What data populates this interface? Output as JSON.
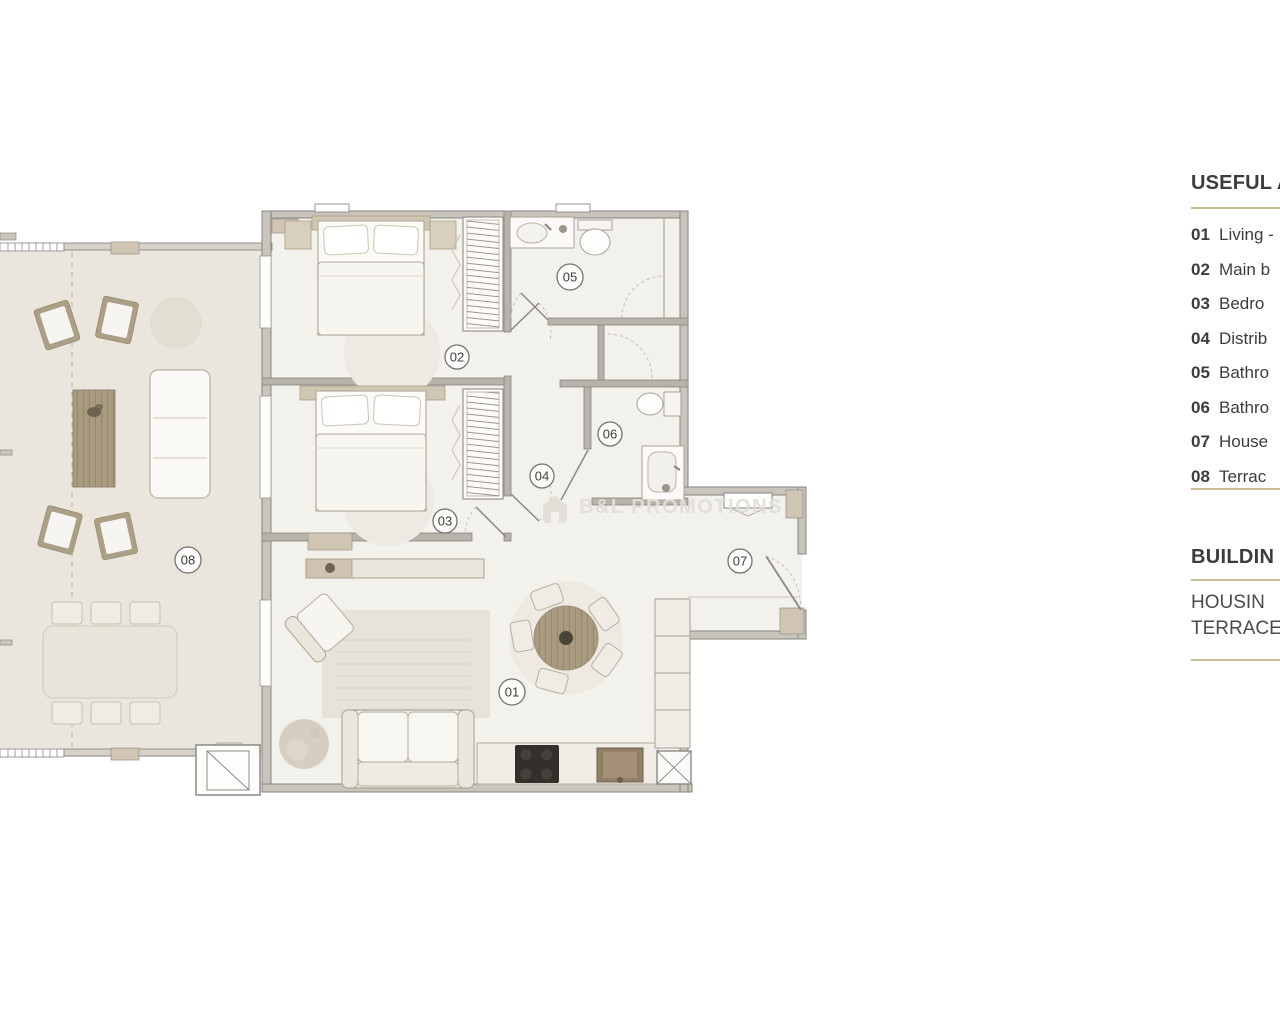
{
  "plan": {
    "room_labels": [
      "01",
      "02",
      "03",
      "04",
      "05",
      "06",
      "07",
      "08"
    ],
    "watermark": {
      "text": "B&L PROMOTIONS",
      "icon": "house-logo-icon"
    }
  },
  "legend": {
    "title": "USEFUL A",
    "items": [
      {
        "num": "01",
        "label": "Living -"
      },
      {
        "num": "02",
        "label": "Main b"
      },
      {
        "num": "03",
        "label": "Bedro"
      },
      {
        "num": "04",
        "label": "Distrib"
      },
      {
        "num": "05",
        "label": "Bathro"
      },
      {
        "num": "06",
        "label": "Bathro"
      },
      {
        "num": "07",
        "label": "House"
      },
      {
        "num": "08",
        "label": "Terrac"
      }
    ],
    "building": {
      "title": "BUILDIN",
      "lines": [
        "HOUSIN",
        "TERRACE"
      ]
    }
  },
  "colors": {
    "separator": "#c9bc92",
    "legend_text": "#3c3c3a",
    "wall": "#8b8884",
    "wall_fill": "#d6d2c9",
    "terrace_floor": "#eae6dd",
    "indoor_floor": "#f3f1ec",
    "accent_beige": "#cfc5b2",
    "wood": "#a2957b",
    "stove": "#332f2a"
  }
}
